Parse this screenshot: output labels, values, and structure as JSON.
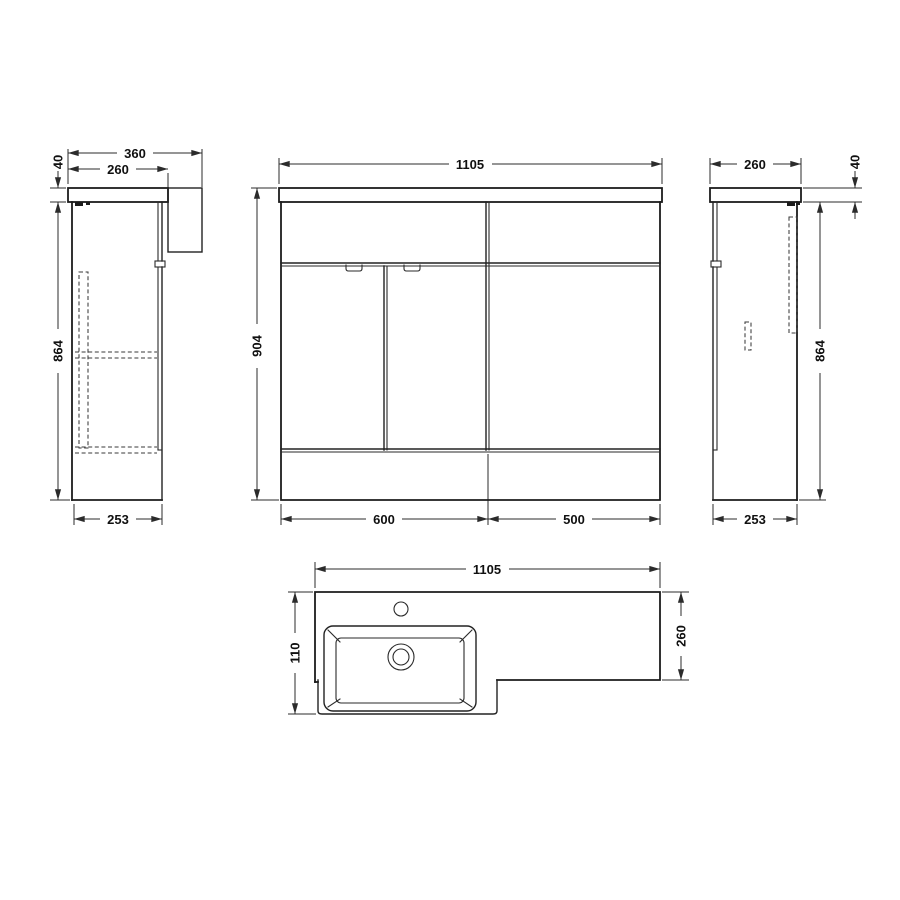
{
  "meta": {
    "drawing_kind": "furniture dimension drawing",
    "line_color": "#1c1c1c",
    "dim_color": "#2b2b2b",
    "worktop_section_fill": "#bfbfbf",
    "background": "#ffffff"
  },
  "dims": {
    "side_left": {
      "overall_depth": "360",
      "worktop_depth": "260",
      "worktop_thickness": "40",
      "carcass_height": "864",
      "base_depth": "253"
    },
    "front": {
      "overall_width": "1105",
      "overall_height": "904",
      "vanity_unit_width": "600",
      "wc_unit_width": "500"
    },
    "side_right": {
      "worktop_depth": "260",
      "worktop_thickness": "40",
      "carcass_height": "864",
      "base_depth": "253"
    },
    "plan": {
      "overall_width": "1105",
      "basin_unit_depth": "110",
      "worktop_depth": "260"
    }
  }
}
